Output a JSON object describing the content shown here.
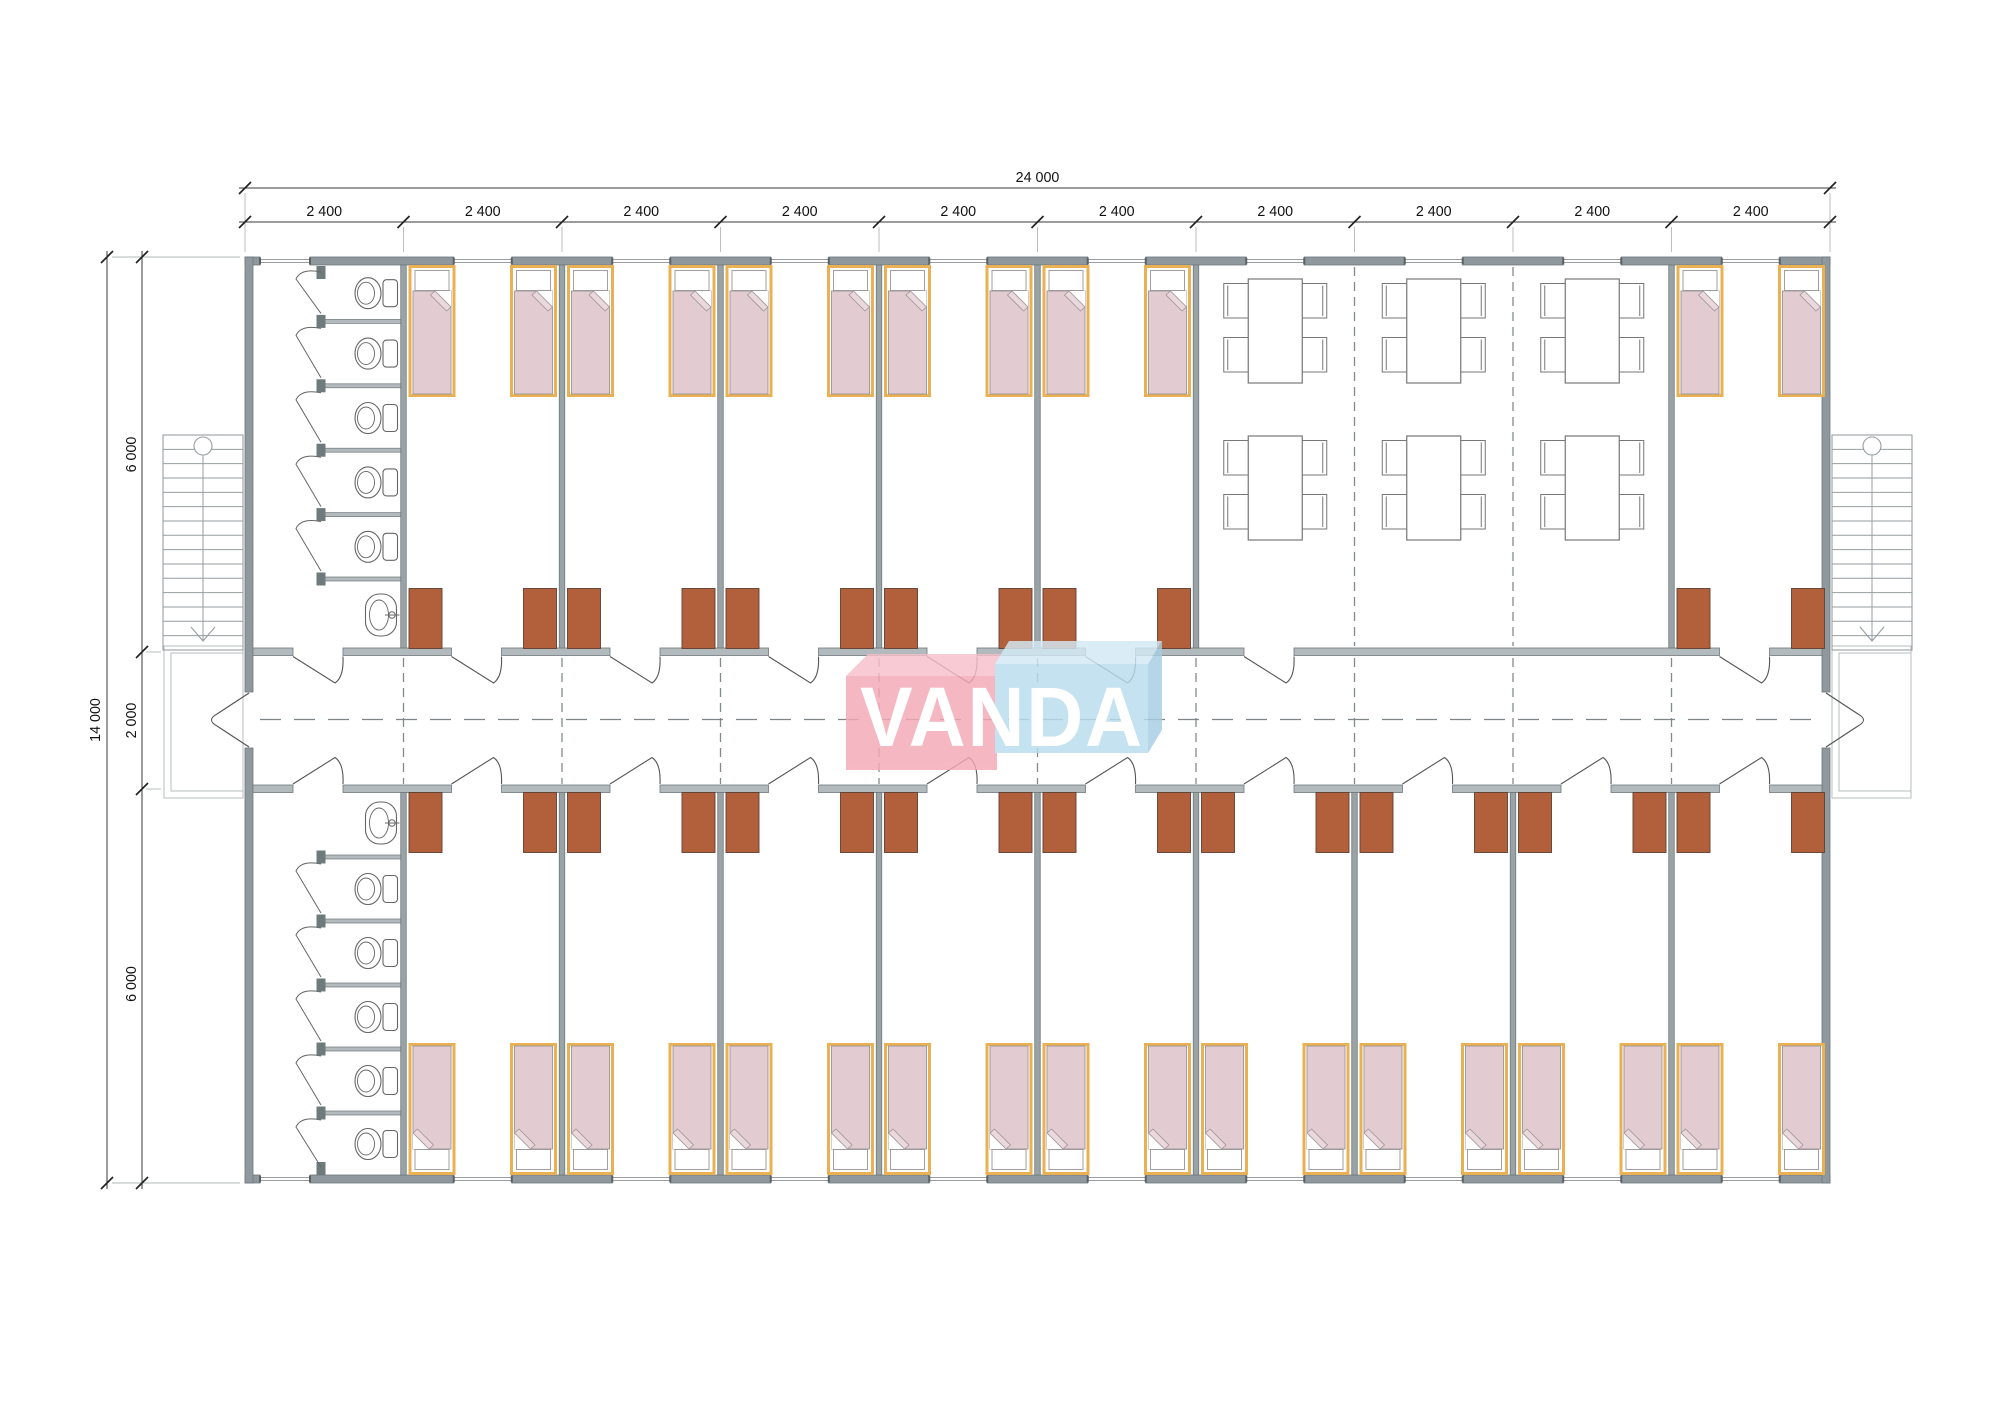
{
  "watermark": {
    "text": "VANDA"
  },
  "dimensions": {
    "top_total_label": "24 000",
    "module_width_label": "2 400",
    "module_count": 10,
    "left_total_label": "14 000",
    "left_upper_label": "6 000",
    "left_corridor_label": "2 000",
    "left_lower_label": "6 000"
  },
  "plan": {
    "building": {
      "type": "modular dormitory floor plan",
      "modules_total": 10,
      "module_width_mm": 2400,
      "depth_mm": 14000,
      "corridor_depth_mm": 2000
    },
    "top_row": {
      "bathroom": {
        "module": 1,
        "toilet_stalls": 5,
        "toilets": 5,
        "sinks": 1
      },
      "bedroom_modules": [
        2,
        3,
        4,
        5,
        6,
        10
      ],
      "beds_per_bedroom": 2,
      "wardrobes_per_bedroom": 2,
      "dining": {
        "modules": [
          7,
          8,
          9
        ],
        "tables": 6,
        "chairs_per_table": 4
      }
    },
    "bottom_row": {
      "bathroom": {
        "module": 1,
        "toilet_stalls": 5,
        "toilets": 5,
        "sinks": 1
      },
      "bedroom_modules": [
        2,
        3,
        4,
        5,
        6,
        7,
        8,
        9,
        10
      ],
      "beds_per_bedroom": 2,
      "wardrobes_per_bedroom": 2
    },
    "circulation": {
      "stairs": 2,
      "entrance_porches": 2,
      "double_entry_doors": 2
    },
    "colors": {
      "outer_wall": "#8f989c",
      "partition_wall": "#9aa3a6",
      "corridor_wall": "#b3babd",
      "wall_edge": "#6e787c",
      "stub": "#6f7a7d",
      "bed_frame": "#e9b054",
      "mattress": "#e2cbd1",
      "mattress_fold": "#ead8dc",
      "pillow_line": "#9a9497",
      "wardrobe": "#b2603c",
      "wardrobe_edge": "#5f4030",
      "furniture_line": "#666666",
      "stairs_line": "#969ea1",
      "porch_line": "#b6bcbe",
      "dash_line": "#828a8d",
      "dimension_line": "#3a3a3a",
      "dimension_tick": "#222222",
      "dimension_text": "#111111",
      "extension_line": "#b3b8ba",
      "watermark_pink": "#f4a9b6",
      "watermark_pink_top": "#f7bfca",
      "watermark_blue": "#b9dcee",
      "watermark_blue_top": "#d3eaf6",
      "watermark_blue_side": "#a6cee3",
      "watermark_text": "#ffffff"
    }
  }
}
